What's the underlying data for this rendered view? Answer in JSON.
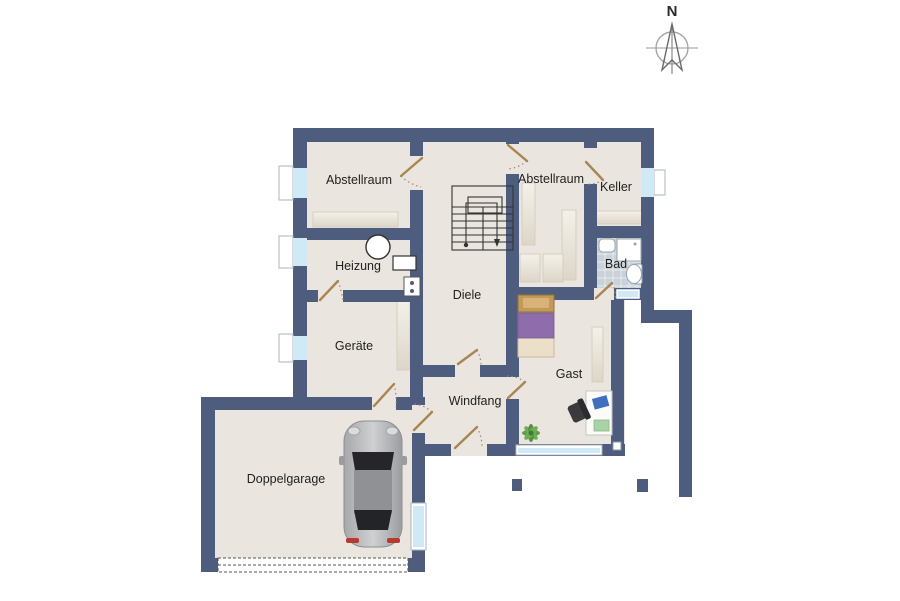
{
  "compass": {
    "north_label": "N"
  },
  "rooms": {
    "abstellraum1": "Abstellraum",
    "abstellraum2": "Abstellraum",
    "keller": "Keller",
    "heizung": "Heizung",
    "diele": "Diele",
    "bad": "Bad",
    "geraete": "Geräte",
    "gast": "Gast",
    "windfang": "Windfang",
    "doppelgarage": "Doppelgarage"
  },
  "colors": {
    "wall": "#4e5c7d",
    "floor": "#eae6df",
    "bath_tile": "#c9d2d9",
    "window_glass": "#cfeaf4",
    "door_leaf": "#a9854f",
    "bed_blanket": "#8f6cab",
    "bed_mattress": "#ecdfc9",
    "plant": "#5f9e4a",
    "car_body": "#b9babc",
    "taillight": "#b8392e"
  }
}
